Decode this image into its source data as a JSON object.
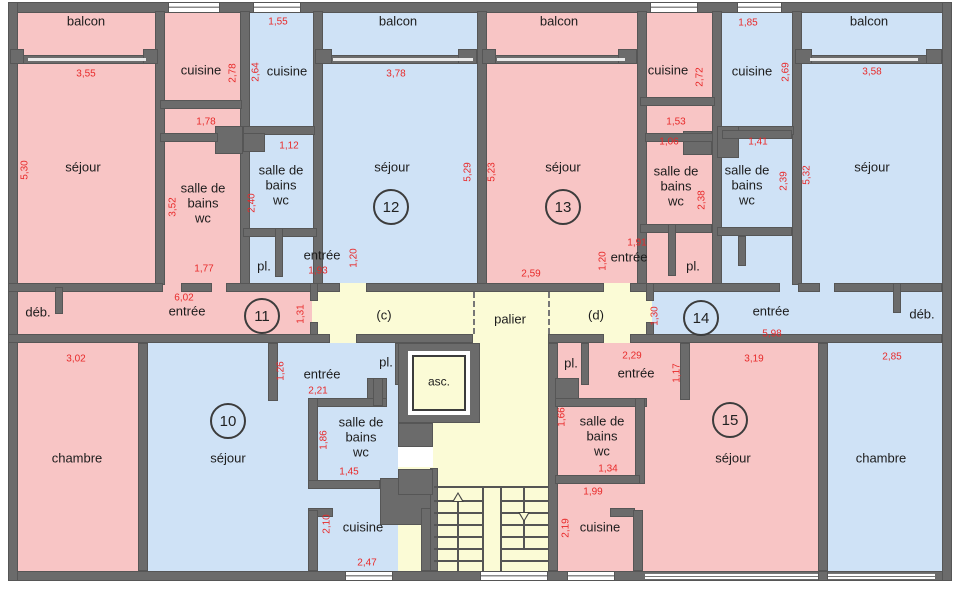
{
  "meta": {
    "title": "Plan d'étage — appartements 10 à 15"
  },
  "colors": {
    "pink": "#f8c5c5",
    "blue": "#cfe2f6",
    "yellow": "#fbfbd6",
    "wall": "#6b6b6b",
    "dim_red": "#e82a2a",
    "text_black": "#1c1c1c",
    "white": "#ffffff"
  },
  "fills": [
    {
      "name": "apt11-upper",
      "color": "pink",
      "rect": [
        18,
        13,
        222,
        272
      ]
    },
    {
      "name": "apt12-upper",
      "color": "blue",
      "rect": [
        250,
        13,
        227,
        272
      ]
    },
    {
      "name": "apt13-upper",
      "color": "pink",
      "rect": [
        487,
        13,
        225,
        272
      ]
    },
    {
      "name": "apt14-upper",
      "color": "blue",
      "rect": [
        722,
        13,
        220,
        272
      ]
    },
    {
      "name": "entree-band-left",
      "color": "pink",
      "rect": [
        18,
        283,
        294,
        60
      ]
    },
    {
      "name": "entree-band-right",
      "color": "blue",
      "rect": [
        652,
        283,
        290,
        60
      ]
    },
    {
      "name": "corridor",
      "color": "yellow",
      "rect": [
        312,
        283,
        340,
        60
      ]
    },
    {
      "name": "chambre-left",
      "color": "pink",
      "rect": [
        18,
        343,
        120,
        228
      ]
    },
    {
      "name": "apt10-lower",
      "color": "blue",
      "rect": [
        148,
        343,
        250,
        228
      ]
    },
    {
      "name": "core",
      "color": "yellow",
      "rect": [
        398,
        343,
        157,
        228
      ]
    },
    {
      "name": "apt15-lower",
      "color": "pink",
      "rect": [
        555,
        343,
        263,
        228
      ]
    },
    {
      "name": "chambre-right",
      "color": "blue",
      "rect": [
        828,
        343,
        114,
        228
      ]
    }
  ],
  "walls": [
    [
      8,
      2,
      944,
      11
    ],
    [
      8,
      571,
      944,
      10
    ],
    [
      8,
      2,
      10,
      579
    ],
    [
      942,
      2,
      10,
      579
    ],
    [
      155,
      11,
      10,
      274
    ],
    [
      240,
      11,
      10,
      274
    ],
    [
      313,
      11,
      10,
      274
    ],
    [
      477,
      11,
      10,
      274
    ],
    [
      637,
      11,
      10,
      274
    ],
    [
      712,
      11,
      10,
      274
    ],
    [
      792,
      11,
      10,
      274
    ],
    [
      18,
      55,
      140,
      9
    ],
    [
      320,
      55,
      157,
      9
    ],
    [
      487,
      55,
      148,
      9
    ],
    [
      800,
      55,
      142,
      9
    ],
    [
      10,
      49,
      14,
      15
    ],
    [
      143,
      49,
      15,
      15
    ],
    [
      315,
      49,
      17,
      15
    ],
    [
      458,
      49,
      19,
      15
    ],
    [
      482,
      49,
      14,
      15
    ],
    [
      618,
      49,
      19,
      15
    ],
    [
      795,
      49,
      17,
      15
    ],
    [
      926,
      49,
      16,
      15
    ],
    [
      160,
      100,
      82,
      9
    ],
    [
      243,
      126,
      72,
      9
    ],
    [
      640,
      97,
      75,
      9
    ],
    [
      717,
      126,
      77,
      9
    ],
    [
      215,
      126,
      28,
      28
    ],
    [
      243,
      133,
      22,
      19
    ],
    [
      683,
      131,
      29,
      24
    ],
    [
      717,
      126,
      22,
      32
    ],
    [
      160,
      133,
      58,
      9
    ],
    [
      645,
      133,
      68,
      9
    ],
    [
      722,
      130,
      70,
      9
    ],
    [
      243,
      228,
      74,
      9
    ],
    [
      640,
      224,
      72,
      9
    ],
    [
      717,
      227,
      75,
      9
    ],
    [
      275,
      228,
      8,
      49
    ],
    [
      668,
      224,
      8,
      52
    ],
    [
      738,
      236,
      8,
      30
    ],
    [
      8,
      283,
      155,
      9
    ],
    [
      181,
      283,
      31,
      9
    ],
    [
      226,
      283,
      114,
      9
    ],
    [
      366,
      283,
      238,
      9
    ],
    [
      630,
      283,
      150,
      9
    ],
    [
      798,
      283,
      22,
      9
    ],
    [
      834,
      283,
      108,
      9
    ],
    [
      310,
      283,
      8,
      18
    ],
    [
      310,
      322,
      8,
      18
    ],
    [
      646,
      283,
      8,
      18
    ],
    [
      646,
      322,
      8,
      18
    ],
    [
      8,
      334,
      322,
      9
    ],
    [
      356,
      334,
      117,
      9
    ],
    [
      548,
      334,
      56,
      9
    ],
    [
      630,
      334,
      312,
      9
    ],
    [
      55,
      287,
      8,
      27
    ],
    [
      893,
      283,
      8,
      30
    ],
    [
      138,
      343,
      10,
      228
    ],
    [
      818,
      343,
      10,
      228
    ],
    [
      548,
      343,
      10,
      228
    ],
    [
      268,
      343,
      10,
      58
    ],
    [
      395,
      343,
      8,
      42
    ],
    [
      367,
      378,
      20,
      22
    ],
    [
      308,
      398,
      79,
      9
    ],
    [
      308,
      398,
      10,
      90
    ],
    [
      308,
      480,
      72,
      9
    ],
    [
      373,
      378,
      10,
      28
    ],
    [
      380,
      478,
      53,
      47
    ],
    [
      308,
      508,
      25,
      9
    ],
    [
      308,
      510,
      10,
      61
    ],
    [
      421,
      508,
      10,
      63
    ],
    [
      680,
      343,
      10,
      57
    ],
    [
      581,
      343,
      8,
      42
    ],
    [
      555,
      378,
      24,
      22
    ],
    [
      555,
      398,
      92,
      9
    ],
    [
      635,
      398,
      10,
      86
    ],
    [
      555,
      475,
      85,
      9
    ],
    [
      610,
      508,
      25,
      9
    ],
    [
      633,
      510,
      10,
      61
    ],
    [
      430,
      468,
      8,
      103
    ],
    [
      398,
      423,
      35,
      24
    ],
    [
      398,
      469,
      35,
      26
    ],
    [
      818,
      571,
      10,
      10
    ]
  ],
  "patches": [
    {
      "color": "white",
      "rect": [
        398,
        447,
        35,
        20
      ]
    }
  ],
  "windows": [
    [
      168,
      2,
      52,
      11
    ],
    [
      253,
      2,
      48,
      11
    ],
    [
      650,
      2,
      48,
      11
    ],
    [
      737,
      2,
      45,
      11
    ],
    [
      345,
      571,
      48,
      10
    ],
    [
      480,
      571,
      68,
      10
    ],
    [
      567,
      571,
      48,
      10
    ]
  ],
  "thin_lines": [
    [
      28,
      58,
      118,
      3
    ],
    [
      333,
      58,
      140,
      3
    ],
    [
      497,
      58,
      128,
      3
    ],
    [
      810,
      58,
      108,
      3
    ]
  ],
  "glaze": [
    [
      645,
      573,
      173,
      6
    ],
    [
      828,
      573,
      107,
      6
    ]
  ],
  "labels": [
    {
      "name": "balcon-11",
      "lines": [
        "balcon"
      ],
      "x": 86,
      "y": 21,
      "size": 13
    },
    {
      "name": "balcon-12",
      "lines": [
        "balcon"
      ],
      "x": 398,
      "y": 21,
      "size": 13
    },
    {
      "name": "balcon-13",
      "lines": [
        "balcon"
      ],
      "x": 559,
      "y": 21,
      "size": 13
    },
    {
      "name": "balcon-14",
      "lines": [
        "balcon"
      ],
      "x": 869,
      "y": 21,
      "size": 13
    },
    {
      "name": "cuisine-11",
      "lines": [
        "cuisine"
      ],
      "x": 201,
      "y": 70,
      "size": 13
    },
    {
      "name": "cuisine-12",
      "lines": [
        "cuisine"
      ],
      "x": 287,
      "y": 71,
      "size": 13
    },
    {
      "name": "cuisine-13",
      "lines": [
        "cuisine"
      ],
      "x": 668,
      "y": 70,
      "size": 13
    },
    {
      "name": "cuisine-14",
      "lines": [
        "cuisine"
      ],
      "x": 752,
      "y": 71,
      "size": 13
    },
    {
      "name": "cuisine-10",
      "lines": [
        "cuisine"
      ],
      "x": 363,
      "y": 527,
      "size": 13
    },
    {
      "name": "cuisine-15",
      "lines": [
        "cuisine"
      ],
      "x": 600,
      "y": 527,
      "size": 13
    },
    {
      "name": "sejour-11",
      "lines": [
        "séjour"
      ],
      "x": 83,
      "y": 167,
      "size": 13
    },
    {
      "name": "sejour-12",
      "lines": [
        "séjour"
      ],
      "x": 392,
      "y": 167,
      "size": 13
    },
    {
      "name": "sejour-13",
      "lines": [
        "séjour"
      ],
      "x": 563,
      "y": 167,
      "size": 13
    },
    {
      "name": "sejour-14",
      "lines": [
        "séjour"
      ],
      "x": 872,
      "y": 167,
      "size": 13
    },
    {
      "name": "sejour-10",
      "lines": [
        "séjour"
      ],
      "x": 228,
      "y": 458,
      "size": 13
    },
    {
      "name": "sejour-15",
      "lines": [
        "séjour"
      ],
      "x": 733,
      "y": 458,
      "size": 13
    },
    {
      "name": "chambre-10",
      "lines": [
        "chambre"
      ],
      "x": 77,
      "y": 458,
      "size": 13
    },
    {
      "name": "chambre-15",
      "lines": [
        "chambre"
      ],
      "x": 881,
      "y": 458,
      "size": 13
    },
    {
      "name": "salle-de-bains-11",
      "lines": [
        "salle de",
        "bains",
        "wc"
      ],
      "x": 203,
      "y": 203,
      "size": 13
    },
    {
      "name": "salle-de-bains-12",
      "lines": [
        "salle de",
        "bains",
        "wc"
      ],
      "x": 281,
      "y": 185,
      "size": 13
    },
    {
      "name": "salle-de-bains-13",
      "lines": [
        "salle de",
        "bains",
        "wc"
      ],
      "x": 676,
      "y": 186,
      "size": 13
    },
    {
      "name": "salle-de-bains-14",
      "lines": [
        "salle de",
        "bains",
        "wc"
      ],
      "x": 747,
      "y": 185,
      "size": 13
    },
    {
      "name": "salle-de-bains-10",
      "lines": [
        "salle de",
        "bains",
        "wc"
      ],
      "x": 361,
      "y": 437,
      "size": 13
    },
    {
      "name": "salle-de-bains-15",
      "lines": [
        "salle de",
        "bains",
        "wc"
      ],
      "x": 602,
      "y": 436,
      "size": 13
    },
    {
      "name": "deb-11",
      "lines": [
        "déb."
      ],
      "x": 38,
      "y": 312,
      "size": 13
    },
    {
      "name": "deb-14",
      "lines": [
        "déb."
      ],
      "x": 922,
      "y": 314,
      "size": 13
    },
    {
      "name": "entree-11",
      "lines": [
        "entrée"
      ],
      "x": 187,
      "y": 311,
      "size": 13
    },
    {
      "name": "entree-12",
      "lines": [
        "entrée"
      ],
      "x": 322,
      "y": 255,
      "size": 13
    },
    {
      "name": "entree-13",
      "lines": [
        "entrée"
      ],
      "x": 629,
      "y": 257,
      "size": 13
    },
    {
      "name": "entree-14",
      "lines": [
        "entrée"
      ],
      "x": 771,
      "y": 311,
      "size": 13
    },
    {
      "name": "entree-10",
      "lines": [
        "entrée"
      ],
      "x": 322,
      "y": 374,
      "size": 13
    },
    {
      "name": "entree-15",
      "lines": [
        "entrée"
      ],
      "x": 636,
      "y": 373,
      "size": 13
    },
    {
      "name": "placard-12",
      "lines": [
        "pl."
      ],
      "x": 264,
      "y": 266,
      "size": 13
    },
    {
      "name": "placard-13",
      "lines": [
        "pl."
      ],
      "x": 693,
      "y": 266,
      "size": 13
    },
    {
      "name": "placard-10",
      "lines": [
        "pl."
      ],
      "x": 386,
      "y": 362,
      "size": 13
    },
    {
      "name": "placard-15",
      "lines": [
        "pl."
      ],
      "x": 571,
      "y": 363,
      "size": 13
    },
    {
      "name": "corridor-c",
      "lines": [
        "(c)"
      ],
      "x": 384,
      "y": 315,
      "size": 13
    },
    {
      "name": "palier",
      "lines": [
        "palier"
      ],
      "x": 510,
      "y": 319,
      "size": 13
    },
    {
      "name": "corridor-d",
      "lines": [
        "(d)"
      ],
      "x": 596,
      "y": 315,
      "size": 13
    }
  ],
  "dims": [
    {
      "v": "3,55",
      "x": 86,
      "y": 74,
      "rot": 0
    },
    {
      "v": "1,78",
      "x": 206,
      "y": 122,
      "rot": 0
    },
    {
      "v": "1,77",
      "x": 204,
      "y": 269,
      "rot": 0
    },
    {
      "v": "6,02",
      "x": 184,
      "y": 298,
      "rot": 0
    },
    {
      "v": "3,02",
      "x": 76,
      "y": 359,
      "rot": 0
    },
    {
      "v": "1,55",
      "x": 278,
      "y": 22,
      "rot": 0
    },
    {
      "v": "1,12",
      "x": 289,
      "y": 146,
      "rot": 0
    },
    {
      "v": "1,93",
      "x": 318,
      "y": 271,
      "rot": 0
    },
    {
      "v": "3,78",
      "x": 396,
      "y": 74,
      "rot": 0
    },
    {
      "v": "2,59",
      "x": 531,
      "y": 274,
      "rot": 0
    },
    {
      "v": "2,21",
      "x": 318,
      "y": 391,
      "rot": 0
    },
    {
      "v": "1,45",
      "x": 349,
      "y": 472,
      "rot": 0
    },
    {
      "v": "2,47",
      "x": 367,
      "y": 563,
      "rot": 0
    },
    {
      "v": "1,53",
      "x": 676,
      "y": 122,
      "rot": 0
    },
    {
      "v": "1,06",
      "x": 669,
      "y": 142,
      "rot": 0
    },
    {
      "v": "1,91",
      "x": 637,
      "y": 243,
      "rot": 0
    },
    {
      "v": "1,85",
      "x": 748,
      "y": 23,
      "rot": 0
    },
    {
      "v": "3,58",
      "x": 872,
      "y": 72,
      "rot": 0
    },
    {
      "v": "1,41",
      "x": 758,
      "y": 142,
      "rot": 0
    },
    {
      "v": "5,98",
      "x": 772,
      "y": 334,
      "rot": 0
    },
    {
      "v": "2,85",
      "x": 892,
      "y": 357,
      "rot": 0
    },
    {
      "v": "3,19",
      "x": 754,
      "y": 359,
      "rot": 0
    },
    {
      "v": "2,29",
      "x": 632,
      "y": 356,
      "rot": 0
    },
    {
      "v": "1,34",
      "x": 608,
      "y": 469,
      "rot": 0
    },
    {
      "v": "1,99",
      "x": 593,
      "y": 492,
      "rot": 0
    },
    {
      "v": "5,30",
      "x": 25,
      "y": 170,
      "rot": 90
    },
    {
      "v": "3,52",
      "x": 173,
      "y": 207,
      "rot": 90
    },
    {
      "v": "2,78",
      "x": 233,
      "y": 73,
      "rot": 90
    },
    {
      "v": "2,64",
      "x": 256,
      "y": 72,
      "rot": 90
    },
    {
      "v": "2,40",
      "x": 252,
      "y": 203,
      "rot": 90
    },
    {
      "v": "1,20",
      "x": 354,
      "y": 258,
      "rot": 90
    },
    {
      "v": "1,26",
      "x": 281,
      "y": 371,
      "rot": 90
    },
    {
      "v": "1,86",
      "x": 324,
      "y": 440,
      "rot": 90
    },
    {
      "v": "2,10",
      "x": 327,
      "y": 524,
      "rot": 90
    },
    {
      "v": "5,29",
      "x": 468,
      "y": 172,
      "rot": 90
    },
    {
      "v": "5,23",
      "x": 492,
      "y": 172,
      "rot": 90
    },
    {
      "v": "1,31",
      "x": 301,
      "y": 314,
      "rot": 90
    },
    {
      "v": "1,20",
      "x": 603,
      "y": 261,
      "rot": 90
    },
    {
      "v": "1,30",
      "x": 655,
      "y": 316,
      "rot": 90
    },
    {
      "v": "2,72",
      "x": 700,
      "y": 77,
      "rot": 90
    },
    {
      "v": "2,69",
      "x": 786,
      "y": 72,
      "rot": 90
    },
    {
      "v": "2,38",
      "x": 702,
      "y": 200,
      "rot": 90
    },
    {
      "v": "2,39",
      "x": 784,
      "y": 181,
      "rot": 90
    },
    {
      "v": "5,32",
      "x": 807,
      "y": 175,
      "rot": 90
    },
    {
      "v": "1,17",
      "x": 677,
      "y": 373,
      "rot": 90
    },
    {
      "v": "1,66",
      "x": 562,
      "y": 417,
      "rot": 90
    },
    {
      "v": "2,19",
      "x": 566,
      "y": 528,
      "rot": 90
    }
  ],
  "apartment_numbers": [
    {
      "v": "10",
      "x": 228,
      "y": 421
    },
    {
      "v": "11",
      "x": 262,
      "y": 316
    },
    {
      "v": "12",
      "x": 391,
      "y": 207
    },
    {
      "v": "13",
      "x": 563,
      "y": 207
    },
    {
      "v": "14",
      "x": 701,
      "y": 318
    },
    {
      "v": "15",
      "x": 730,
      "y": 420
    }
  ],
  "dashes": [
    [
      473,
      292,
      42
    ],
    [
      548,
      292,
      42
    ]
  ],
  "elevator": {
    "label": "asc.",
    "shaft": [
      398,
      343,
      82,
      80
    ],
    "gap": [
      408,
      351,
      62,
      64
    ],
    "cab": [
      412,
      355,
      54,
      56
    ],
    "label_x": 439,
    "label_y": 382
  },
  "stairs": {
    "treads": [
      [
        434,
        486,
        114,
        2
      ],
      [
        434,
        500,
        48,
        2
      ],
      [
        434,
        512,
        48,
        2
      ],
      [
        434,
        524,
        48,
        2
      ],
      [
        434,
        536,
        48,
        2
      ],
      [
        434,
        548,
        48,
        2
      ],
      [
        434,
        560,
        48,
        2
      ],
      [
        500,
        500,
        48,
        2
      ],
      [
        500,
        512,
        48,
        2
      ],
      [
        500,
        524,
        48,
        2
      ],
      [
        500,
        536,
        48,
        2
      ],
      [
        500,
        548,
        48,
        2
      ],
      [
        500,
        560,
        48,
        2
      ],
      [
        482,
        486,
        2,
        85
      ],
      [
        500,
        486,
        2,
        85
      ],
      [
        457,
        500,
        2,
        71
      ],
      [
        523,
        488,
        2,
        60
      ]
    ],
    "arrow_up": [
      452,
      492
    ],
    "arrow_down": [
      518,
      512
    ]
  }
}
